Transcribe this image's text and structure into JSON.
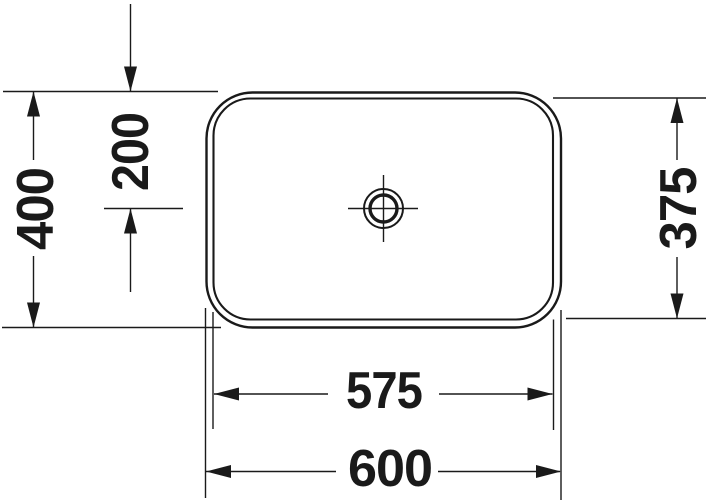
{
  "drawing": {
    "title": "washbasin-plan-view-dimension-drawing",
    "background": "#ffffff",
    "line_color": "#1a1a1a",
    "dims": {
      "overall_width": "600",
      "inner_width": "575",
      "overall_depth": "400",
      "inner_depth": "375",
      "drain_center_offset": "200"
    }
  }
}
